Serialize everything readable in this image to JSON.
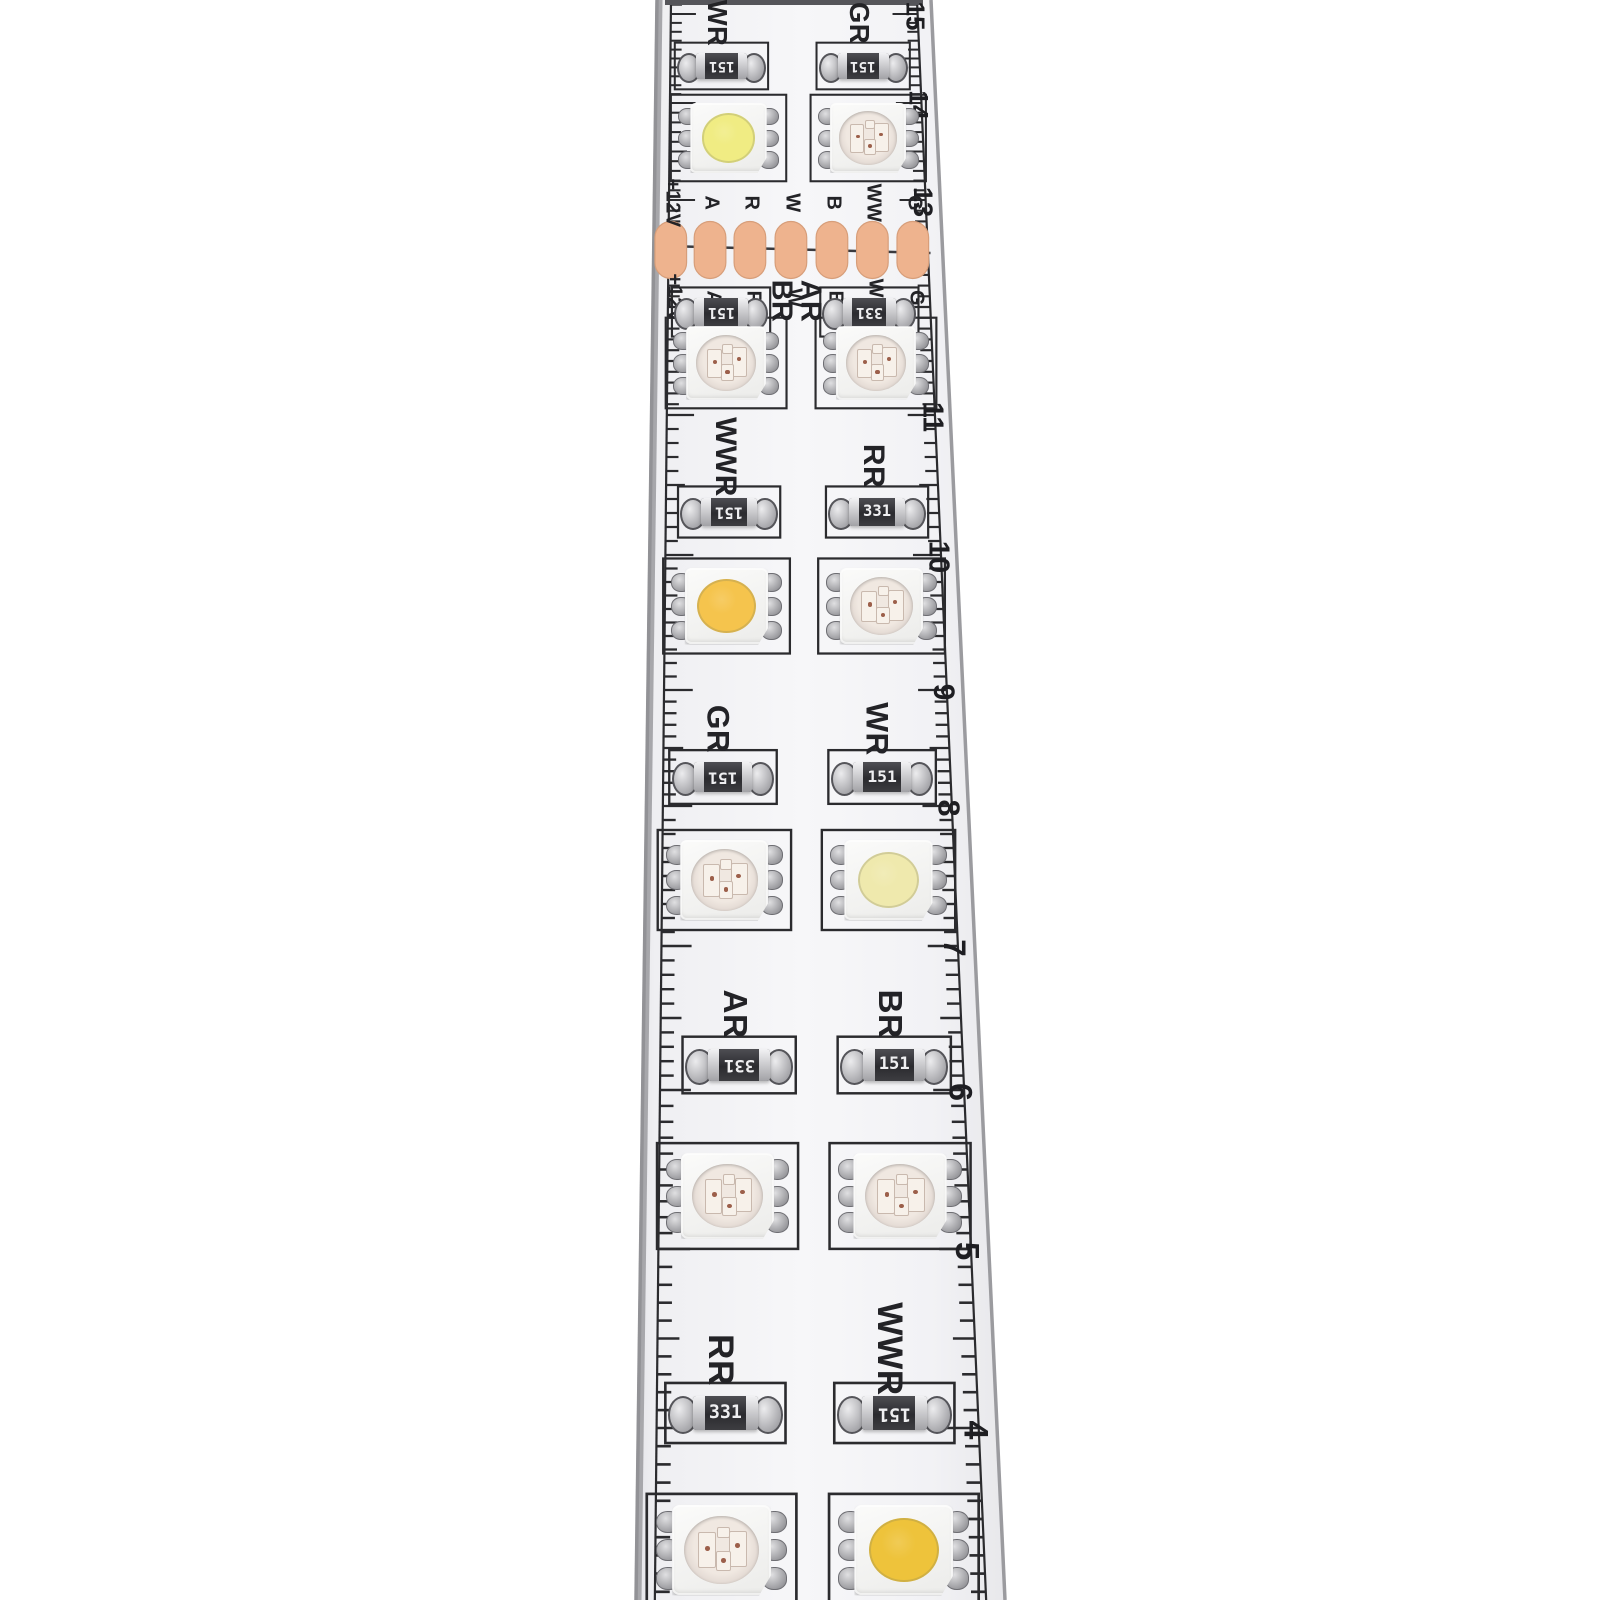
{
  "photo": {
    "colors": {
      "background": "#ffffff",
      "pcb": "#f4f4f6",
      "pcb_edge": "#929296",
      "copper_pad": "#eeb38e",
      "copper_pad_edge": "#d79e7a",
      "silkscreen": "#2b2b2e",
      "resistor_body": "#333337",
      "resistor_text": "#efeff1",
      "metal": "#a9a9ad"
    }
  },
  "ruler": {
    "numbers": [
      {
        "label": "15",
        "y": 14
      },
      {
        "label": "14",
        "y": 103
      },
      {
        "label": "13",
        "y": 200
      },
      {
        "label": "",
        "y": 307
      },
      {
        "label": "11",
        "y": 415
      },
      {
        "label": "10",
        "y": 555
      },
      {
        "label": "9",
        "y": 690
      },
      {
        "label": "8",
        "y": 806
      },
      {
        "label": "7",
        "y": 946
      },
      {
        "label": "6",
        "y": 1090
      },
      {
        "label": "5",
        "y": 1249
      },
      {
        "label": "4",
        "y": 1428
      }
    ]
  },
  "solder_pads": {
    "y": 250,
    "labels_top": [
      "+12V",
      "A",
      "R",
      "W",
      "B",
      "WW",
      "G"
    ],
    "labels_bottom": [
      "+12V",
      "A",
      "R",
      "W",
      "B",
      "WW",
      "G"
    ],
    "cols": [
      0.059,
      0.195,
      0.333,
      0.475,
      0.617,
      0.757,
      0.897
    ]
  },
  "resistor_rows": [
    {
      "y": 66,
      "items": [
        {
          "col": 0.235,
          "label": "WR",
          "code": "151",
          "flip": true,
          "label_pos": "top"
        },
        {
          "col": 0.745,
          "label": "GR",
          "code": "151",
          "flip": true,
          "label_pos": "top"
        }
      ]
    },
    {
      "y": 312,
      "items": [
        {
          "col": 0.233,
          "label": "BR",
          "code": "151",
          "flip": true,
          "label_pos": "right"
        },
        {
          "col": 0.74,
          "label": "AR",
          "code": "331",
          "flip": true,
          "label_pos": "left"
        }
      ]
    },
    {
      "y": 512,
      "items": [
        {
          "col": 0.259,
          "label": "WWR",
          "code": "151",
          "flip": true,
          "label_pos": "top"
        },
        {
          "col": 0.745,
          "label": "RR",
          "code": "331",
          "flip": false,
          "label_pos": "top"
        }
      ]
    },
    {
      "y": 777,
      "items": [
        {
          "col": 0.238,
          "label": "GR",
          "code": "151",
          "flip": true,
          "label_pos": "top"
        },
        {
          "col": 0.735,
          "label": "WR",
          "code": "151",
          "flip": false,
          "label_pos": "top"
        }
      ]
    },
    {
      "y": 1065,
      "items": [
        {
          "col": 0.285,
          "label": "AR",
          "code": "331",
          "flip": true,
          "label_pos": "top"
        },
        {
          "col": 0.745,
          "label": "BR",
          "code": "151",
          "flip": false,
          "label_pos": "top"
        }
      ]
    },
    {
      "y": 1413,
      "items": [
        {
          "col": 0.243,
          "label": "RR",
          "code": "331",
          "flip": false,
          "label_pos": "top"
        },
        {
          "col": 0.715,
          "label": "WWR",
          "code": "151",
          "flip": true,
          "label_pos": "top"
        }
      ]
    }
  ],
  "led_rows": [
    {
      "y": 138,
      "items": [
        {
          "col": 0.26,
          "type": "white",
          "lens": "#f0ec83"
        },
        {
          "col": 0.755,
          "type": "rgb"
        }
      ]
    },
    {
      "y": 363,
      "items": [
        {
          "col": 0.25,
          "type": "rgb"
        },
        {
          "col": 0.757,
          "type": "rgb"
        }
      ]
    },
    {
      "y": 606,
      "items": [
        {
          "col": 0.25,
          "type": "white",
          "lens": "#f5c44d"
        },
        {
          "col": 0.75,
          "type": "rgb"
        }
      ]
    },
    {
      "y": 880,
      "items": [
        {
          "col": 0.242,
          "type": "rgb"
        },
        {
          "col": 0.745,
          "type": "white",
          "lens": "#efe9ad"
        }
      ]
    },
    {
      "y": 1196,
      "items": [
        {
          "col": 0.25,
          "type": "rgb"
        },
        {
          "col": 0.75,
          "type": "rgb"
        }
      ]
    },
    {
      "y": 1550,
      "items": [
        {
          "col": 0.232,
          "type": "rgb"
        },
        {
          "col": 0.73,
          "type": "white",
          "lens": "#eec33b"
        }
      ]
    }
  ]
}
